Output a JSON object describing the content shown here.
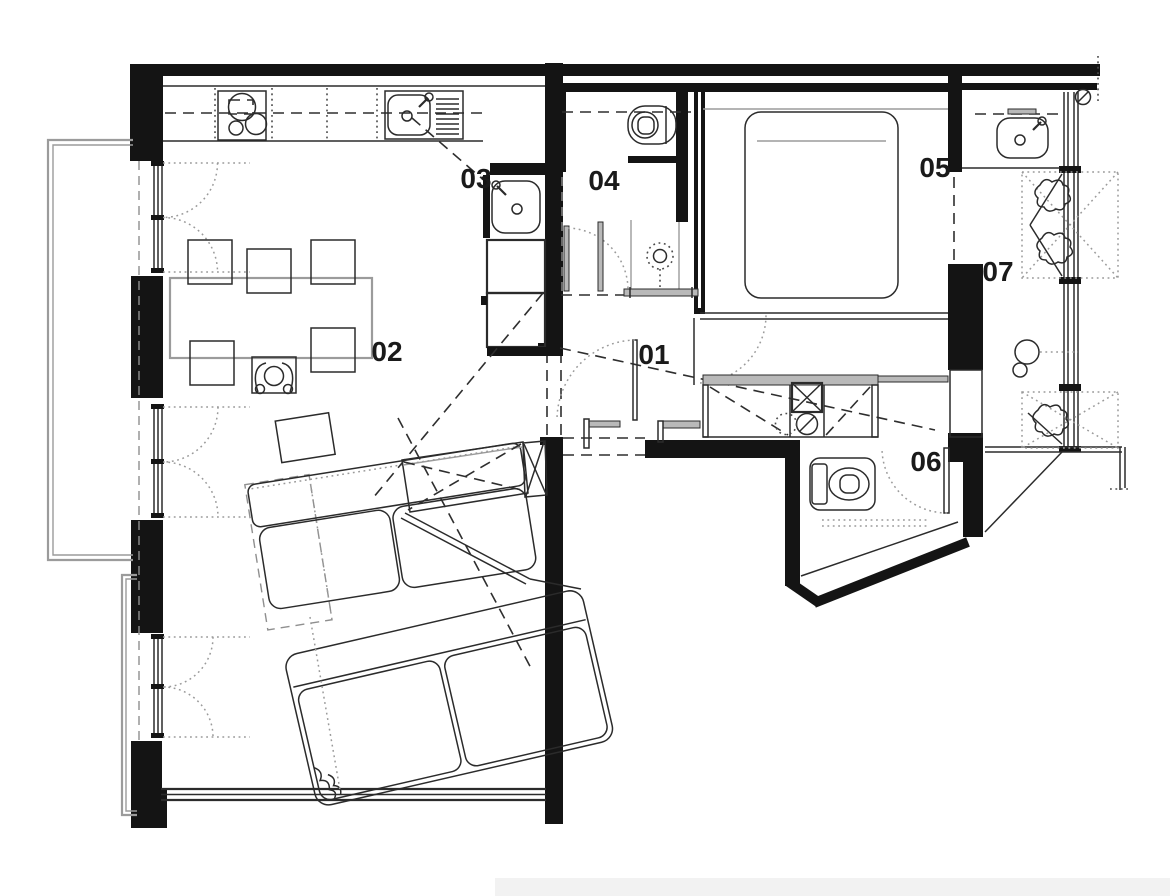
{
  "meta": {
    "type": "architectural-floor-plan",
    "background": "#ffffff"
  },
  "rooms": [
    {
      "id": "hallway",
      "label": "01"
    },
    {
      "id": "living-dining",
      "label": "02"
    },
    {
      "id": "kitchen",
      "label": "03"
    },
    {
      "id": "bathroom",
      "label": "04"
    },
    {
      "id": "bedroom",
      "label": "05"
    },
    {
      "id": "wc",
      "label": "06"
    },
    {
      "id": "loggia",
      "label": "07"
    }
  ],
  "fixtures": [
    {
      "id": "cooktop-icon",
      "room": "03"
    },
    {
      "id": "kitchen-sink-icon",
      "room": "03"
    },
    {
      "id": "utility-basin-icon",
      "room": "03"
    },
    {
      "id": "base-cabinets",
      "room": "03"
    },
    {
      "id": "dining-table",
      "room": "02",
      "chairs": 6
    },
    {
      "id": "seated-person-icon",
      "room": "02"
    },
    {
      "id": "sectional-sofa",
      "room": "02"
    },
    {
      "id": "sideboard",
      "room": "02"
    },
    {
      "id": "side-table",
      "room": "02"
    },
    {
      "id": "toilet-icon",
      "room": "04"
    },
    {
      "id": "shower-head-icon",
      "room": "04"
    },
    {
      "id": "bench",
      "room": "04"
    },
    {
      "id": "double-bed",
      "room": "05"
    },
    {
      "id": "wardrobe-closet",
      "room": "01"
    },
    {
      "id": "washing-machine-icon",
      "room": "01"
    },
    {
      "id": "dryer-icon",
      "room": "01"
    },
    {
      "id": "toilet-icon-2",
      "room": "06"
    },
    {
      "id": "washbasin-icon",
      "room": "07"
    },
    {
      "id": "plant-icon",
      "room": "07",
      "count": 3
    },
    {
      "id": "balcony",
      "room": "02"
    },
    {
      "id": "casement-window",
      "room": "02",
      "count": 3
    }
  ],
  "colors": {
    "wall": "#141414",
    "line": "#2b2b2b",
    "gray": "#9b9b9b",
    "label": "#1a1a1a",
    "background": "#ffffff"
  }
}
